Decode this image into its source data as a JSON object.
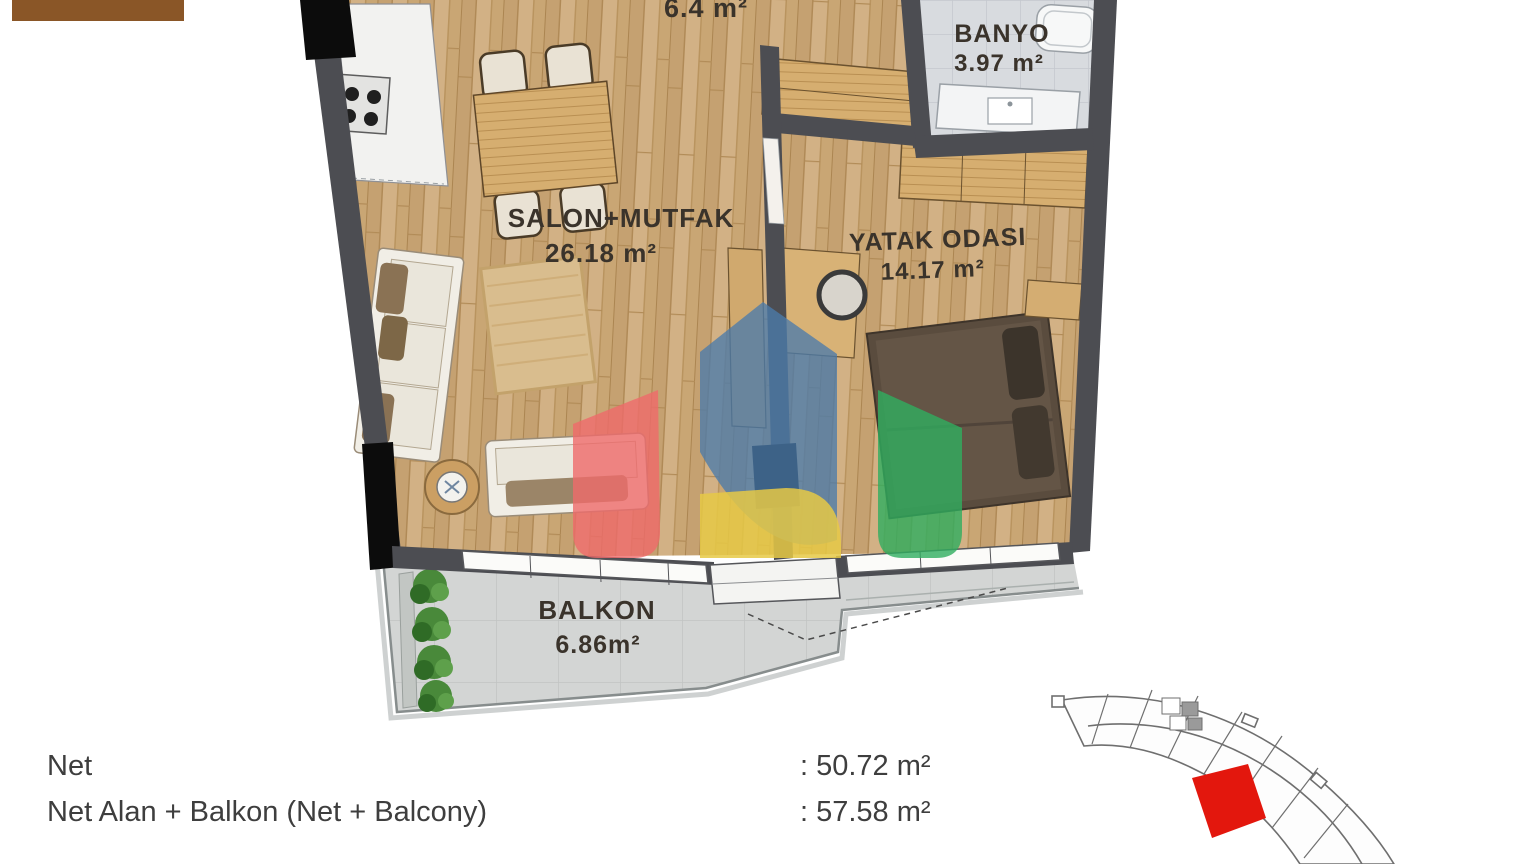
{
  "floor_plan": {
    "hall": {
      "area": "6.4 m²"
    },
    "banyo": {
      "name": "BANYO",
      "area": "3.97 m²"
    },
    "salon": {
      "name": "SALON+MUTFAK",
      "area": "26.18 m²"
    },
    "bedroom": {
      "name": "YATAK ODASI",
      "area": "14.17 m²"
    },
    "balcony": {
      "name": "BALKON",
      "area": "6.86m²"
    }
  },
  "summary": {
    "rows": [
      {
        "label": "Net",
        "value": ": 50.72 m²"
      },
      {
        "label": "Net Alan + Balkon (Net + Balcony)",
        "value": ": 57.58 m²"
      }
    ]
  },
  "watermark": {
    "blue": "#4c7bab",
    "red": "#ef6a6a",
    "green": "#2fae5f",
    "yellow": "#e6c945"
  },
  "key_plan": {
    "highlight_color": "#e3170d"
  }
}
